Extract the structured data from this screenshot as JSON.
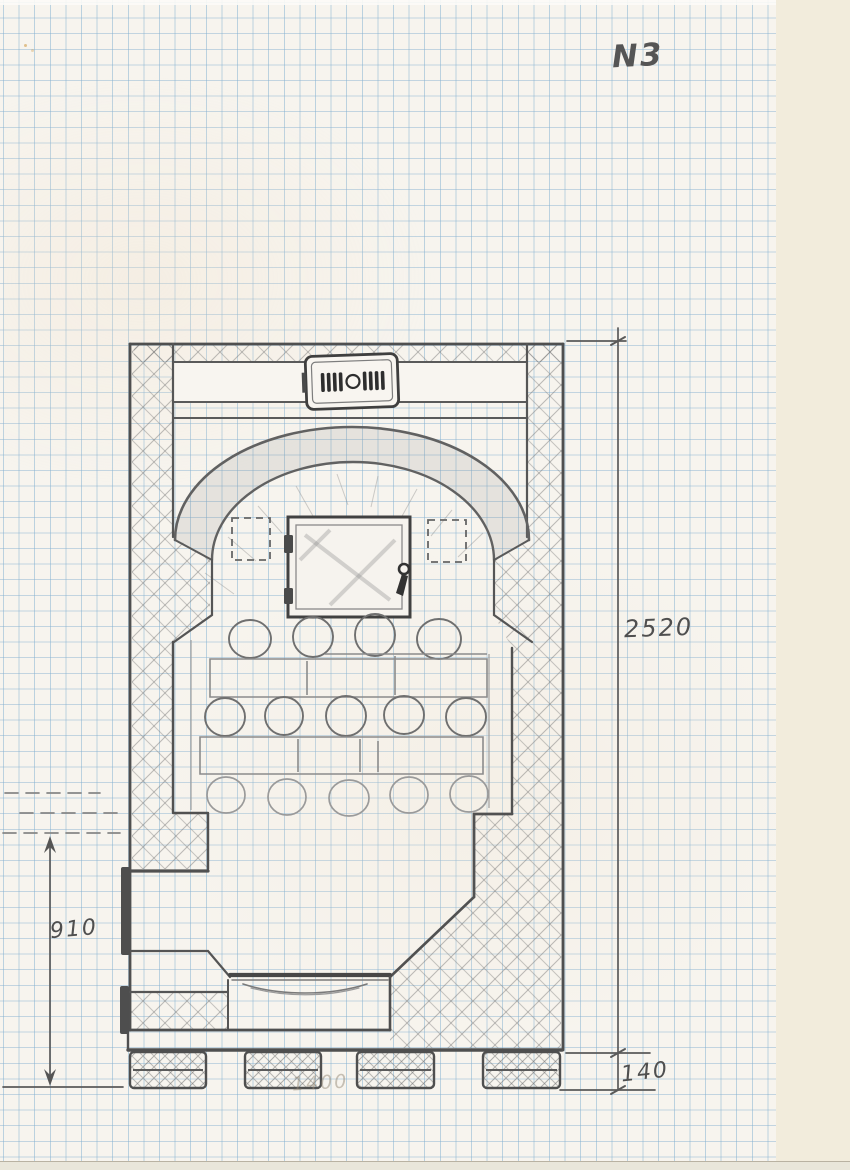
{
  "sheet": {
    "number_label": "N3",
    "media": "squared graph paper, pencil hand drawing",
    "drawing_subject": "stove-plan-sketch"
  },
  "dimensions": {
    "overall_height": {
      "value": "2520"
    },
    "opening_height": {
      "value": "910"
    },
    "base_height": {
      "value": "140"
    },
    "erased_note": {
      "value": "1400"
    }
  },
  "colors": {
    "pencil": "#555555",
    "pencil_dark": "#3f3f3f",
    "pencil_light": "#9a9a9a",
    "grid_blue": "#80aecf",
    "paper": "#f7f4ee",
    "scan_background": "#f2ecdc"
  }
}
